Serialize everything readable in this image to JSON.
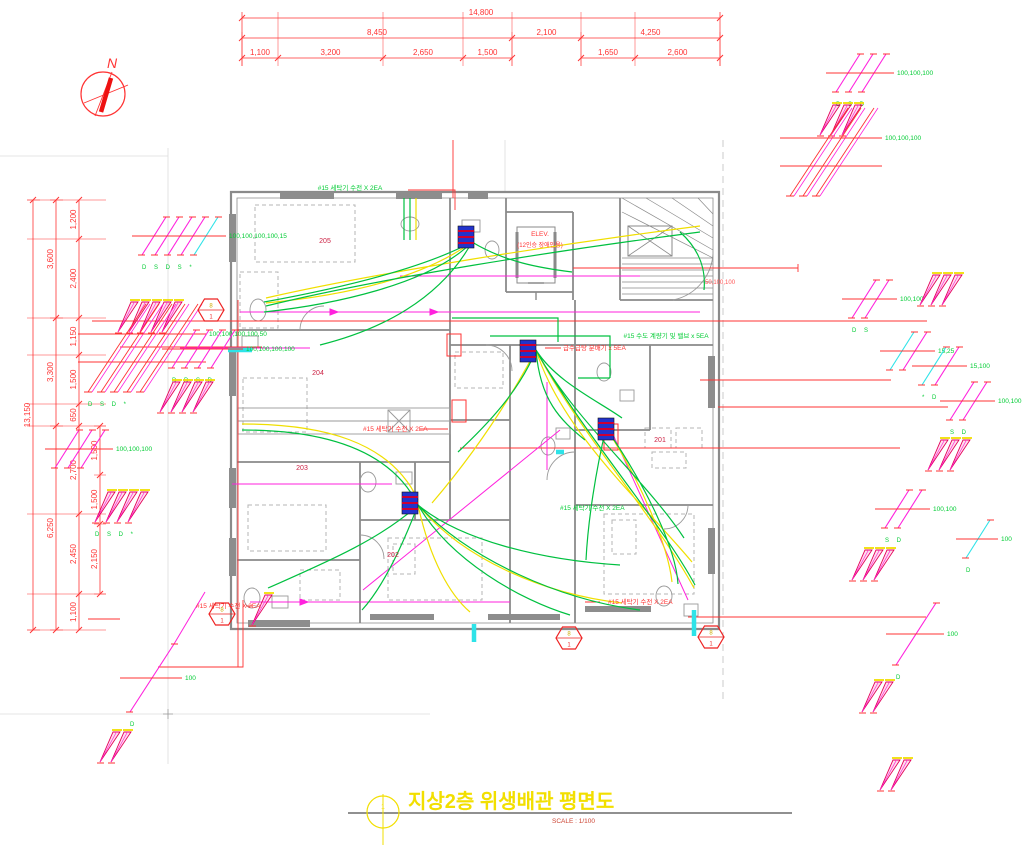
{
  "title": {
    "text": "지상2층 위생배관 평면도",
    "scale": "SCALE : 1/100",
    "circle_no": "1"
  },
  "compass": {
    "label": "N"
  },
  "colors": {
    "dimension_red": "#ff3333",
    "pipe_green": "#00c040",
    "pipe_yellow": "#f0df00",
    "pipe_magenta": "#ff22dd",
    "pipe_cyan": "#2ee3e8",
    "label_green": "#00cc33",
    "wall_gray": "#8a8a8a",
    "title_yellow": "#f2df00"
  },
  "dimensions": {
    "chains": [
      {
        "o": "h",
        "pos": 18,
        "ticks": [
          242,
          720
        ],
        "labels": [
          "14,800"
        ],
        "ext": [
          12,
          66
        ]
      },
      {
        "o": "h",
        "pos": 38,
        "ticks": [
          242,
          512,
          581,
          720
        ],
        "labels": [
          "8,450",
          "2,100",
          "4,250"
        ],
        "ext": [
          32,
          66
        ]
      },
      {
        "o": "h",
        "pos": 58,
        "ticks": [
          242,
          278,
          383,
          463,
          512
        ],
        "labels": [
          "1,100",
          "3,200",
          "2,650",
          "1,500"
        ],
        "ext": [
          12,
          66
        ]
      },
      {
        "o": "h",
        "pos": 58,
        "ticks": [
          581,
          635,
          720
        ],
        "labels": [
          "1,650",
          "2,600"
        ],
        "ext": [
          12,
          66
        ]
      },
      {
        "o": "v",
        "pos": 33,
        "ticks": [
          200,
          630
        ],
        "labels": [
          "13,150"
        ],
        "ext": [
          27,
          40
        ]
      },
      {
        "o": "v",
        "pos": 56,
        "ticks": [
          200,
          318,
          426,
          630
        ],
        "labels": [
          "3,600",
          "3,300",
          "6,250"
        ],
        "ext": [
          50,
          63
        ]
      },
      {
        "o": "v",
        "pos": 79,
        "ticks": [
          200,
          239,
          318,
          355,
          404,
          426,
          514,
          594,
          630
        ],
        "labels": [
          "1,200",
          "2,400",
          "1,150",
          "1,500",
          "650",
          "2,700",
          "2,450",
          "1,100"
        ],
        "ext": [
          27,
          106
        ]
      },
      {
        "o": "v",
        "pos": 100,
        "ticks": [
          426,
          475,
          524,
          594
        ],
        "labels": [
          "1,500",
          "1,500",
          "2,150"
        ],
        "ext": [
          94,
          106
        ]
      }
    ]
  },
  "rooms": [
    "201",
    "202",
    "203",
    "204",
    "205"
  ],
  "labels": [
    {
      "x": 350,
      "y": 190,
      "t": "#15 세탁기 수전 X 2EA",
      "c": "#00cc33",
      "s": 6.5,
      "a": "middle"
    },
    {
      "x": 666,
      "y": 338,
      "t": "#15 수도 계량기 및 밸브 x 5EA",
      "c": "#00cc33",
      "s": 6.5,
      "a": "middle"
    },
    {
      "x": 563,
      "y": 350,
      "t": "급수급탕 분배기 x 5EA",
      "c": "#ff3333",
      "s": 6.5,
      "a": "start"
    },
    {
      "x": 363,
      "y": 431,
      "t": "#15 세탁기 수전 X 2EA",
      "c": "#ff3333",
      "s": 6.5,
      "a": "start"
    },
    {
      "x": 608,
      "y": 604,
      "t": "#15 세탁기 수전 X 2EA",
      "c": "#ff3333",
      "s": 6.5,
      "a": "start"
    },
    {
      "x": 560,
      "y": 510,
      "t": "#15 세탁기 수전 X 2EA",
      "c": "#00cc33",
      "s": 6.5,
      "a": "start"
    },
    {
      "x": 196,
      "y": 608,
      "t": "#15 세탁기 수전 X 2EA",
      "c": "#ff3333",
      "s": 6.5,
      "a": "start"
    },
    {
      "x": 540,
      "y": 236,
      "t": "ELEV.",
      "c": "#ff3333",
      "s": 6.5,
      "a": "middle"
    },
    {
      "x": 540,
      "y": 247,
      "t": "(12인승 장애인용)",
      "c": "#ff3333",
      "s": 6,
      "a": "middle"
    },
    {
      "x": 325,
      "y": 243,
      "t": "205",
      "c": "#cc2244",
      "s": 7,
      "a": "middle"
    },
    {
      "x": 318,
      "y": 375,
      "t": "204",
      "c": "#cc2244",
      "s": 7,
      "a": "middle"
    },
    {
      "x": 302,
      "y": 470,
      "t": "203",
      "c": "#cc2244",
      "s": 7,
      "a": "middle"
    },
    {
      "x": 393,
      "y": 557,
      "t": "202",
      "c": "#cc2244",
      "s": 7,
      "a": "middle"
    },
    {
      "x": 660,
      "y": 442,
      "t": "201",
      "c": "#cc2244",
      "s": 7,
      "a": "middle"
    },
    {
      "x": 705,
      "y": 284,
      "t": "50,100,100",
      "c": "#ff5555",
      "s": 6,
      "a": "start"
    }
  ],
  "risers": [
    {
      "type": "sleeve",
      "n": 3,
      "x": 836,
      "y": 92,
      "label": "100,100,100",
      "letters": "D S D"
    },
    {
      "type": "fan",
      "n": 3,
      "x": 820,
      "y": 135
    },
    {
      "type": "hatch",
      "n": 3,
      "x": 790,
      "y": 196,
      "label": "100,100,100"
    },
    {
      "type": "sleeve",
      "n": 2,
      "x": 852,
      "y": 318,
      "label": "100,100",
      "letters": "D S"
    },
    {
      "type": "fan",
      "n": 3,
      "x": 920,
      "y": 305
    },
    {
      "type": "sleeve",
      "n": 2,
      "x": 890,
      "y": 370,
      "cyan": [
        0
      ],
      "label": "15,25"
    },
    {
      "type": "sleeve",
      "n": 2,
      "x": 922,
      "y": 385,
      "cyan": [
        0
      ],
      "label": "15,100",
      "letters": "* D"
    },
    {
      "type": "sleeve",
      "n": 2,
      "x": 950,
      "y": 420,
      "label": "100,100",
      "letters": "S D"
    },
    {
      "type": "fan",
      "n": 3,
      "x": 928,
      "y": 470
    },
    {
      "type": "sleeve",
      "n": 2,
      "x": 885,
      "y": 528,
      "label": "100,100",
      "letters": "S D"
    },
    {
      "type": "fan",
      "n": 3,
      "x": 852,
      "y": 580
    },
    {
      "type": "sleeve",
      "n": 1,
      "x": 966,
      "y": 558,
      "cyan": [
        0
      ],
      "label": "100",
      "letters": "D"
    },
    {
      "type": "sleeve",
      "n": 1,
      "x": 896,
      "y": 665,
      "dx": 40,
      "dy": -62,
      "label": "100",
      "letters": "D"
    },
    {
      "type": "fan",
      "n": 2,
      "x": 862,
      "y": 712
    },
    {
      "type": "fan",
      "n": 2,
      "x": 880,
      "y": 790
    },
    {
      "type": "sleeve",
      "n": 5,
      "x": 142,
      "y": 255,
      "cyan": [
        4
      ],
      "label": "100,100,100,100,15",
      "letters": "D S D S *"
    },
    {
      "type": "fan",
      "n": 5,
      "x": 118,
      "y": 332
    },
    {
      "type": "hatch",
      "n": 5,
      "x": 88,
      "y": 392,
      "label": "100,100,100,100,50",
      "letters": "D S D *"
    },
    {
      "type": "sleeve",
      "n": 4,
      "x": 172,
      "y": 368,
      "label": "100,100,100,100",
      "letters": "D D S D"
    },
    {
      "type": "fan",
      "n": 4,
      "x": 160,
      "y": 412
    },
    {
      "type": "sleeve",
      "n": 3,
      "x": 55,
      "y": 468,
      "label": "100,100,100"
    },
    {
      "type": "fan",
      "n": 4,
      "x": 95,
      "y": 522,
      "letters": "D S D *"
    },
    {
      "type": "sleeve",
      "n": 1,
      "x": 130,
      "y": 712,
      "dx": 44,
      "dy": -68,
      "label": "100",
      "letters": "D"
    },
    {
      "type": "fan",
      "n": 2,
      "x": 100,
      "y": 762
    },
    {
      "type": "fan",
      "n": 1,
      "x": 252,
      "y": 625
    }
  ],
  "hexagons": [
    {
      "x": 211,
      "y": 310,
      "top": "8",
      "bottom": "1"
    },
    {
      "x": 222,
      "y": 614,
      "top": "8",
      "bottom": "1"
    },
    {
      "x": 569,
      "y": 638,
      "top": "8",
      "bottom": "1"
    },
    {
      "x": 711,
      "y": 637,
      "top": "8",
      "bottom": "1"
    }
  ],
  "manifolds": [
    {
      "x": 466,
      "y": 226
    },
    {
      "x": 528,
      "y": 340
    },
    {
      "x": 410,
      "y": 492
    },
    {
      "x": 606,
      "y": 418
    }
  ]
}
